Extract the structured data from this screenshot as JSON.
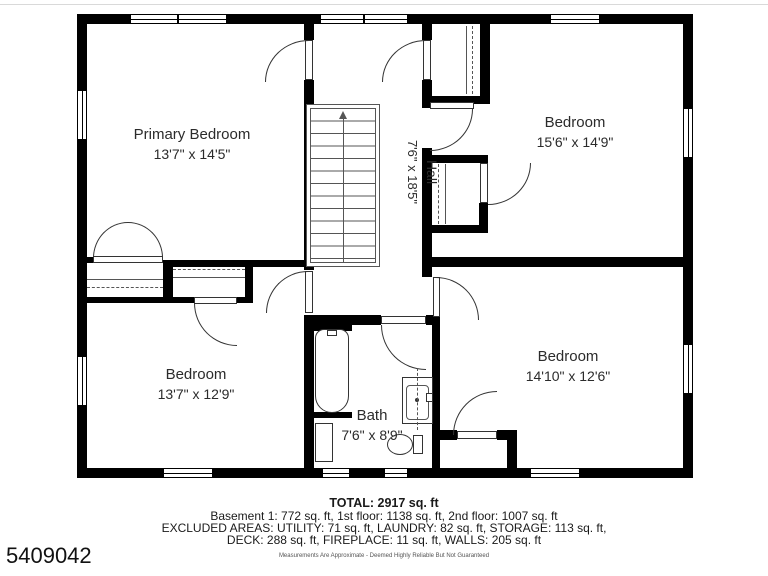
{
  "colors": {
    "wall": "#000000",
    "thin_line": "#333333",
    "text": "#2b2b2b"
  },
  "rooms": [
    {
      "name": "Primary Bedroom",
      "dims": "13'7\" x 14'5\""
    },
    {
      "name": "Bedroom",
      "dims": "15'6\" x 14'9\""
    },
    {
      "name": "Hall",
      "dims": "7'6\" x 18'5\""
    },
    {
      "name": "Bedroom",
      "dims": "13'7\" x 12'9\""
    },
    {
      "name": "Bath",
      "dims": "7'6\" x 8'9\""
    },
    {
      "name": "Bedroom",
      "dims": "14'10\" x 12'6\""
    }
  ],
  "summary": {
    "total": "TOTAL: 2917 sq. ft",
    "line1": "Basement 1: 772 sq. ft, 1st floor: 1138 sq. ft, 2nd floor: 1007 sq. ft",
    "line2": "EXCLUDED AREAS: UTILITY: 71 sq. ft, LAUNDRY: 82 sq. ft, STORAGE: 113 sq. ft,",
    "line3": "DECK: 288 sq. ft, FIREPLACE: 11 sq. ft, WALLS: 205 sq. ft",
    "disclaimer": "Measurements Are Approximate - Deemed Highly Reliable But Not Guaranteed"
  },
  "mls_number": "5409042"
}
